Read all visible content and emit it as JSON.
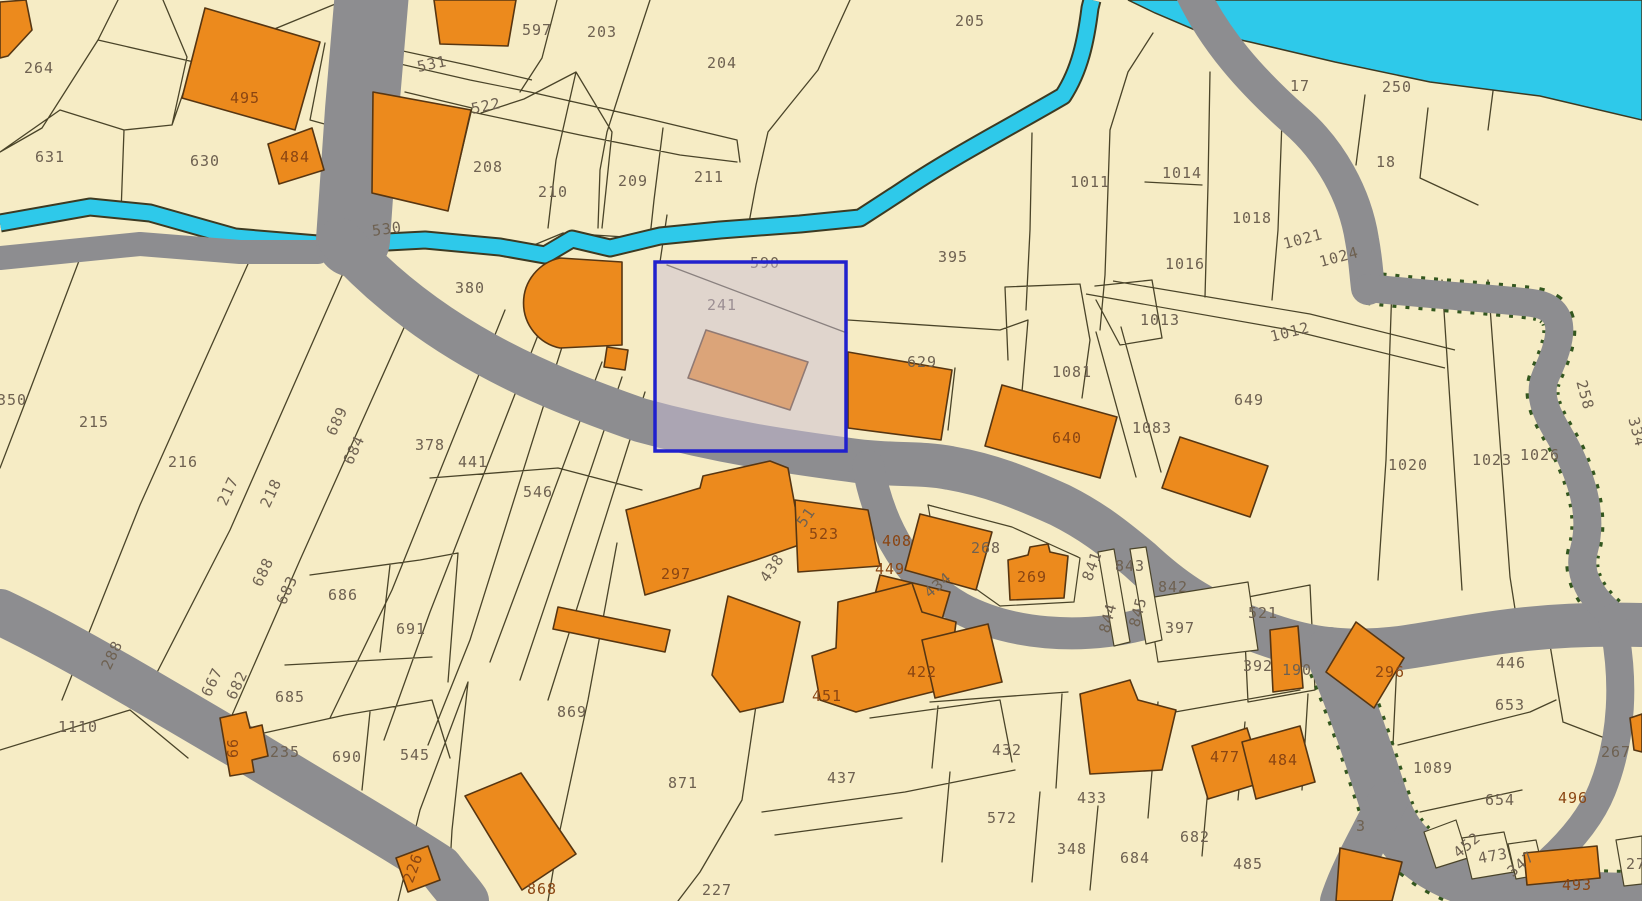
{
  "map": {
    "type": "cadastral-parcel-map",
    "selection": {
      "parcel_number": "241",
      "section_label": "590"
    },
    "palette": {
      "parcel_fill": "#f6ecc5",
      "boundary_line": "#4a4429",
      "road_gray": "#8d8d90",
      "water_cyan": "#2ec9ea",
      "building_orange": "#ec8a1d",
      "building_outline": "#573612",
      "selection_blue": "#2121cd",
      "selection_overlay": "rgba(202,190,214,0.5)",
      "label_parcel": "#6e6151",
      "label_building": "#8a4512",
      "road_edge_green": "#33571e"
    },
    "labels": [
      {
        "t": "264",
        "x": 39,
        "y": 68
      },
      {
        "t": "631",
        "x": 50,
        "y": 157
      },
      {
        "t": "630",
        "x": 205,
        "y": 161
      },
      {
        "t": "495",
        "x": 245,
        "y": 98,
        "c": "b"
      },
      {
        "t": "484",
        "x": 295,
        "y": 157,
        "c": "b"
      },
      {
        "t": "597",
        "x": 537,
        "y": 30
      },
      {
        "t": "203",
        "x": 602,
        "y": 32
      },
      {
        "t": "204",
        "x": 722,
        "y": 63
      },
      {
        "t": "205",
        "x": 970,
        "y": 21
      },
      {
        "t": "531",
        "x": 432,
        "y": 64,
        "r": -12
      },
      {
        "t": "522",
        "x": 486,
        "y": 106,
        "r": -12
      },
      {
        "t": "208",
        "x": 488,
        "y": 167
      },
      {
        "t": "210",
        "x": 553,
        "y": 192
      },
      {
        "t": "209",
        "x": 633,
        "y": 181
      },
      {
        "t": "211",
        "x": 709,
        "y": 177
      },
      {
        "t": "530",
        "x": 387,
        "y": 229,
        "r": -8
      },
      {
        "t": "380",
        "x": 470,
        "y": 288
      },
      {
        "t": "590",
        "x": 765,
        "y": 263
      },
      {
        "t": "241",
        "x": 722,
        "y": 305
      },
      {
        "t": "395",
        "x": 953,
        "y": 257
      },
      {
        "t": "17",
        "x": 1300,
        "y": 86
      },
      {
        "t": "250",
        "x": 1397,
        "y": 87
      },
      {
        "t": "18",
        "x": 1386,
        "y": 162
      },
      {
        "t": "1011",
        "x": 1090,
        "y": 182
      },
      {
        "t": "1014",
        "x": 1182,
        "y": 173
      },
      {
        "t": "1016",
        "x": 1185,
        "y": 264
      },
      {
        "t": "1018",
        "x": 1252,
        "y": 218
      },
      {
        "t": "1021",
        "x": 1303,
        "y": 239,
        "r": -15
      },
      {
        "t": "1024",
        "x": 1339,
        "y": 257,
        "r": -15
      },
      {
        "t": "1013",
        "x": 1160,
        "y": 320
      },
      {
        "t": "1012",
        "x": 1290,
        "y": 332,
        "r": -14
      },
      {
        "t": "629",
        "x": 922,
        "y": 362
      },
      {
        "t": "1081",
        "x": 1072,
        "y": 372
      },
      {
        "t": "649",
        "x": 1249,
        "y": 400
      },
      {
        "t": "1083",
        "x": 1152,
        "y": 428
      },
      {
        "t": "640",
        "x": 1067,
        "y": 438,
        "c": "b"
      },
      {
        "t": "1020",
        "x": 1408,
        "y": 465
      },
      {
        "t": "1023",
        "x": 1492,
        "y": 460
      },
      {
        "t": "1026",
        "x": 1540,
        "y": 455
      },
      {
        "t": "258",
        "x": 1585,
        "y": 395,
        "r": 75
      },
      {
        "t": "334",
        "x": 1637,
        "y": 432,
        "r": 75
      },
      {
        "t": "350",
        "x": 12,
        "y": 400
      },
      {
        "t": "215",
        "x": 94,
        "y": 422
      },
      {
        "t": "216",
        "x": 183,
        "y": 462
      },
      {
        "t": "217",
        "x": 228,
        "y": 491,
        "r": -65
      },
      {
        "t": "218",
        "x": 271,
        "y": 493,
        "r": -65
      },
      {
        "t": "689",
        "x": 337,
        "y": 421,
        "r": -65
      },
      {
        "t": "684",
        "x": 354,
        "y": 450,
        "r": -65
      },
      {
        "t": "378",
        "x": 430,
        "y": 445
      },
      {
        "t": "441",
        "x": 473,
        "y": 462
      },
      {
        "t": "546",
        "x": 538,
        "y": 492
      },
      {
        "t": "297",
        "x": 676,
        "y": 574,
        "c": "b"
      },
      {
        "t": "51",
        "x": 806,
        "y": 517,
        "r": -55
      },
      {
        "t": "438",
        "x": 772,
        "y": 568,
        "r": -55
      },
      {
        "t": "523",
        "x": 824,
        "y": 534,
        "c": "b"
      },
      {
        "t": "408",
        "x": 897,
        "y": 541,
        "c": "b"
      },
      {
        "t": "449",
        "x": 890,
        "y": 569,
        "c": "b"
      },
      {
        "t": "434",
        "x": 938,
        "y": 585,
        "r": -40
      },
      {
        "t": "268",
        "x": 986,
        "y": 548
      },
      {
        "t": "269",
        "x": 1032,
        "y": 577,
        "c": "b"
      },
      {
        "t": "841",
        "x": 1092,
        "y": 566,
        "r": -70
      },
      {
        "t": "843",
        "x": 1130,
        "y": 566
      },
      {
        "t": "842",
        "x": 1173,
        "y": 587
      },
      {
        "t": "844",
        "x": 1108,
        "y": 618,
        "r": -75
      },
      {
        "t": "845",
        "x": 1138,
        "y": 612,
        "r": -75
      },
      {
        "t": "397",
        "x": 1180,
        "y": 628
      },
      {
        "t": "521",
        "x": 1263,
        "y": 613
      },
      {
        "t": "392",
        "x": 1258,
        "y": 666
      },
      {
        "t": "190",
        "x": 1297,
        "y": 670
      },
      {
        "t": "296",
        "x": 1390,
        "y": 672,
        "c": "b"
      },
      {
        "t": "288",
        "x": 112,
        "y": 655,
        "r": -65
      },
      {
        "t": "667",
        "x": 212,
        "y": 682,
        "r": -65
      },
      {
        "t": "682",
        "x": 237,
        "y": 685,
        "r": -65
      },
      {
        "t": "683",
        "x": 287,
        "y": 590,
        "r": -65
      },
      {
        "t": "688",
        "x": 263,
        "y": 572,
        "r": -65
      },
      {
        "t": "686",
        "x": 343,
        "y": 595
      },
      {
        "t": "691",
        "x": 411,
        "y": 629
      },
      {
        "t": "685",
        "x": 290,
        "y": 697
      },
      {
        "t": "1110",
        "x": 78,
        "y": 727
      },
      {
        "t": "66",
        "x": 233,
        "y": 748,
        "r": -90,
        "c": "b"
      },
      {
        "t": "235",
        "x": 285,
        "y": 752
      },
      {
        "t": "690",
        "x": 347,
        "y": 757
      },
      {
        "t": "545",
        "x": 415,
        "y": 755
      },
      {
        "t": "226",
        "x": 413,
        "y": 868,
        "r": -70,
        "c": "b"
      },
      {
        "t": "868",
        "x": 542,
        "y": 889,
        "c": "b"
      },
      {
        "t": "869",
        "x": 572,
        "y": 712
      },
      {
        "t": "871",
        "x": 683,
        "y": 783
      },
      {
        "t": "227",
        "x": 717,
        "y": 890
      },
      {
        "t": "437",
        "x": 842,
        "y": 778
      },
      {
        "t": "451",
        "x": 827,
        "y": 696,
        "c": "b"
      },
      {
        "t": "422",
        "x": 922,
        "y": 672,
        "c": "b"
      },
      {
        "t": "432",
        "x": 1007,
        "y": 750
      },
      {
        "t": "572",
        "x": 1002,
        "y": 818
      },
      {
        "t": "433",
        "x": 1092,
        "y": 798
      },
      {
        "t": "348",
        "x": 1072,
        "y": 849
      },
      {
        "t": "684",
        "x": 1135,
        "y": 858
      },
      {
        "t": "682",
        "x": 1195,
        "y": 837
      },
      {
        "t": "485",
        "x": 1248,
        "y": 864
      },
      {
        "t": "477",
        "x": 1225,
        "y": 757,
        "c": "b"
      },
      {
        "t": "484",
        "x": 1283,
        "y": 760,
        "c": "b"
      },
      {
        "t": "3",
        "x": 1361,
        "y": 826
      },
      {
        "t": "1089",
        "x": 1433,
        "y": 768
      },
      {
        "t": "446",
        "x": 1511,
        "y": 663
      },
      {
        "t": "653",
        "x": 1510,
        "y": 705
      },
      {
        "t": "267",
        "x": 1616,
        "y": 752
      },
      {
        "t": "654",
        "x": 1500,
        "y": 800
      },
      {
        "t": "496",
        "x": 1573,
        "y": 798,
        "c": "b"
      },
      {
        "t": "452",
        "x": 1467,
        "y": 845,
        "r": -40
      },
      {
        "t": "473",
        "x": 1493,
        "y": 856,
        "r": -10
      },
      {
        "t": "347",
        "x": 1521,
        "y": 864,
        "r": -40
      },
      {
        "t": "493",
        "x": 1577,
        "y": 885,
        "c": "b"
      },
      {
        "t": "27",
        "x": 1636,
        "y": 864
      }
    ]
  }
}
